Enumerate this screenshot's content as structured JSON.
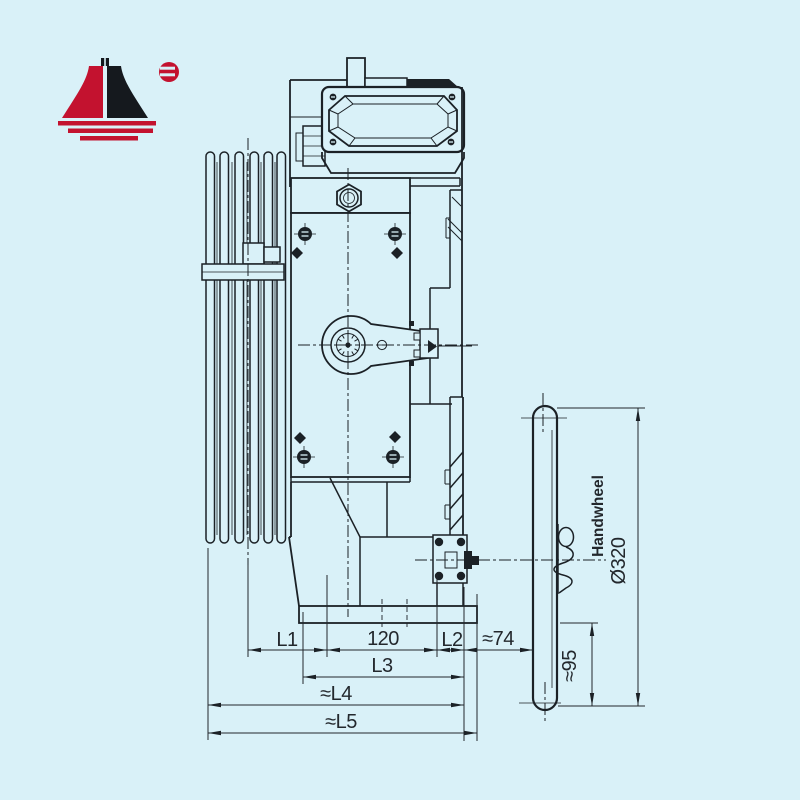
{
  "window": {
    "background": "#d9f1f8",
    "line_color": "#1b2126"
  },
  "logo": {
    "name": "tower-logo",
    "red": "#c3122f",
    "black": "#15191e"
  },
  "drawing": {
    "type": "elevator-traction-machine-side-view",
    "parts": [
      "traction-sheave",
      "rope-guard",
      "terminal-box",
      "cable-gland",
      "oil-plug",
      "gear-housing",
      "brake-release-lever",
      "brake-drum",
      "mounting-base",
      "worm-shaft-end",
      "handwheel",
      "r-clip"
    ],
    "labels": {
      "l1": "L1",
      "d120": "120",
      "l2": "L2",
      "d74": "≈74",
      "l3": "L3",
      "l4": "≈L4",
      "l5": "≈L5",
      "d95": "≈95",
      "d320": "Ø320",
      "handwheel": "Handwheel"
    }
  }
}
